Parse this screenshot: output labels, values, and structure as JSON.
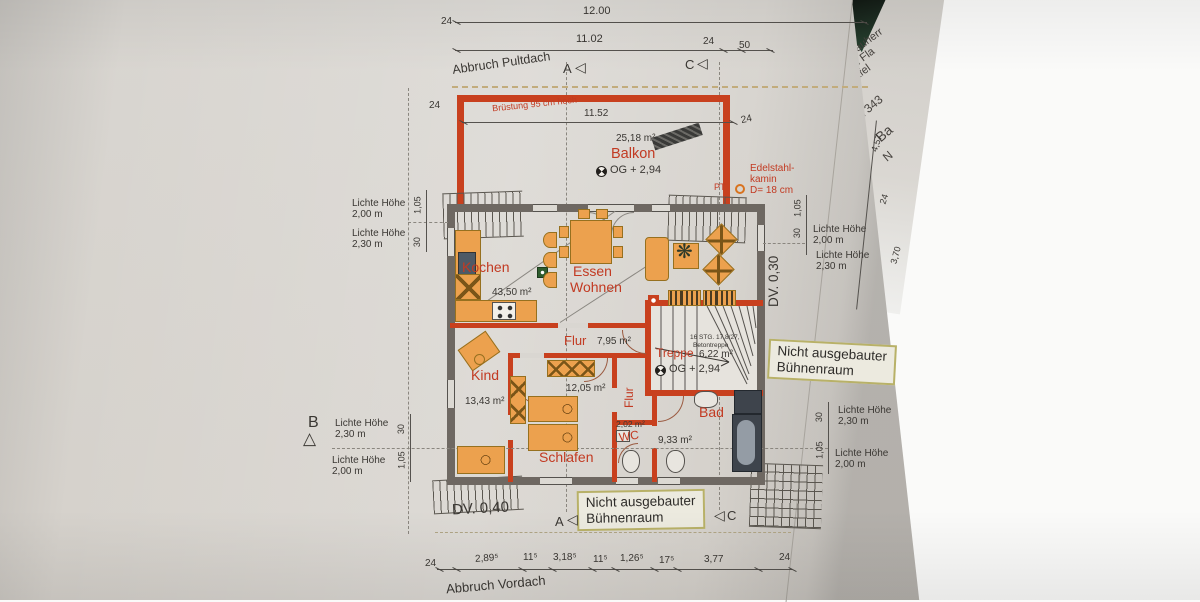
{
  "sheet": {
    "abbruch_pultdach": "Abbruch Pultdach",
    "abbruch_vordach": "Abbruch Vordach",
    "dv_030": "DV. 0,30",
    "dv_040": "DV. 0,40",
    "attic_line1": "Nicht ausgebauter",
    "attic_line2": "Bühnenraum"
  },
  "markers": {
    "a": "A",
    "b": "B",
    "c": "C",
    "tri_left": "◁",
    "tri_up": "△"
  },
  "balcony": {
    "area": "25,18 m²",
    "name": "Balkon",
    "level": "OG + 2,94",
    "bruestung": "Brüstung 95 cm hoch",
    "pt": "PT",
    "kamin_l1": "Edelstahl-",
    "kamin_l2": "kamin",
    "kamin_l3": "D= 18 cm"
  },
  "rooms": {
    "kochen": {
      "name": "Kochen",
      "area": "43,50 m²"
    },
    "essen": {
      "line1": "Essen",
      "line2": "Wohnen"
    },
    "flur": {
      "name": "Flur",
      "area": "7,95 m²"
    },
    "flur_v": {
      "name": "Flur"
    },
    "treppe": {
      "name": "Treppe",
      "area": "6,22 m²",
      "level": "OG + 2,94",
      "note1": "16 STG. 17,8/27,",
      "note2": "Betontreppe"
    },
    "kind": {
      "name": "Kind",
      "area": "13,43 m²"
    },
    "schlafen": {
      "name": "Schlafen",
      "area": "12,05 m²"
    },
    "bad": {
      "name": "Bad",
      "area": "9,33 m²"
    },
    "wc": {
      "name": "WC",
      "area": "2,02 m²"
    }
  },
  "clearance": {
    "label": "Lichte Höhe",
    "h200": "2,00 m",
    "h230": "2,30 m"
  },
  "dims": {
    "top_total": "12.00",
    "row2": [
      "24",
      "11.02",
      "24",
      "50"
    ],
    "balcony_width": "11.52",
    "side_left": "24",
    "side_right": "24",
    "bottom": [
      "24",
      "2,89⁵",
      "11⁵",
      "3,18⁵",
      "11⁵",
      "1,26⁵",
      "17⁵",
      "3,77",
      "24"
    ],
    "v105": "1,05",
    "v30": "30"
  },
  "edge": {
    "dims": [
      "4,57",
      "24",
      "3,70"
    ],
    "page2": [
      "auherr",
      "lfi Fla",
      "üttfel",
      "7343",
      "Ba",
      "N"
    ]
  }
}
